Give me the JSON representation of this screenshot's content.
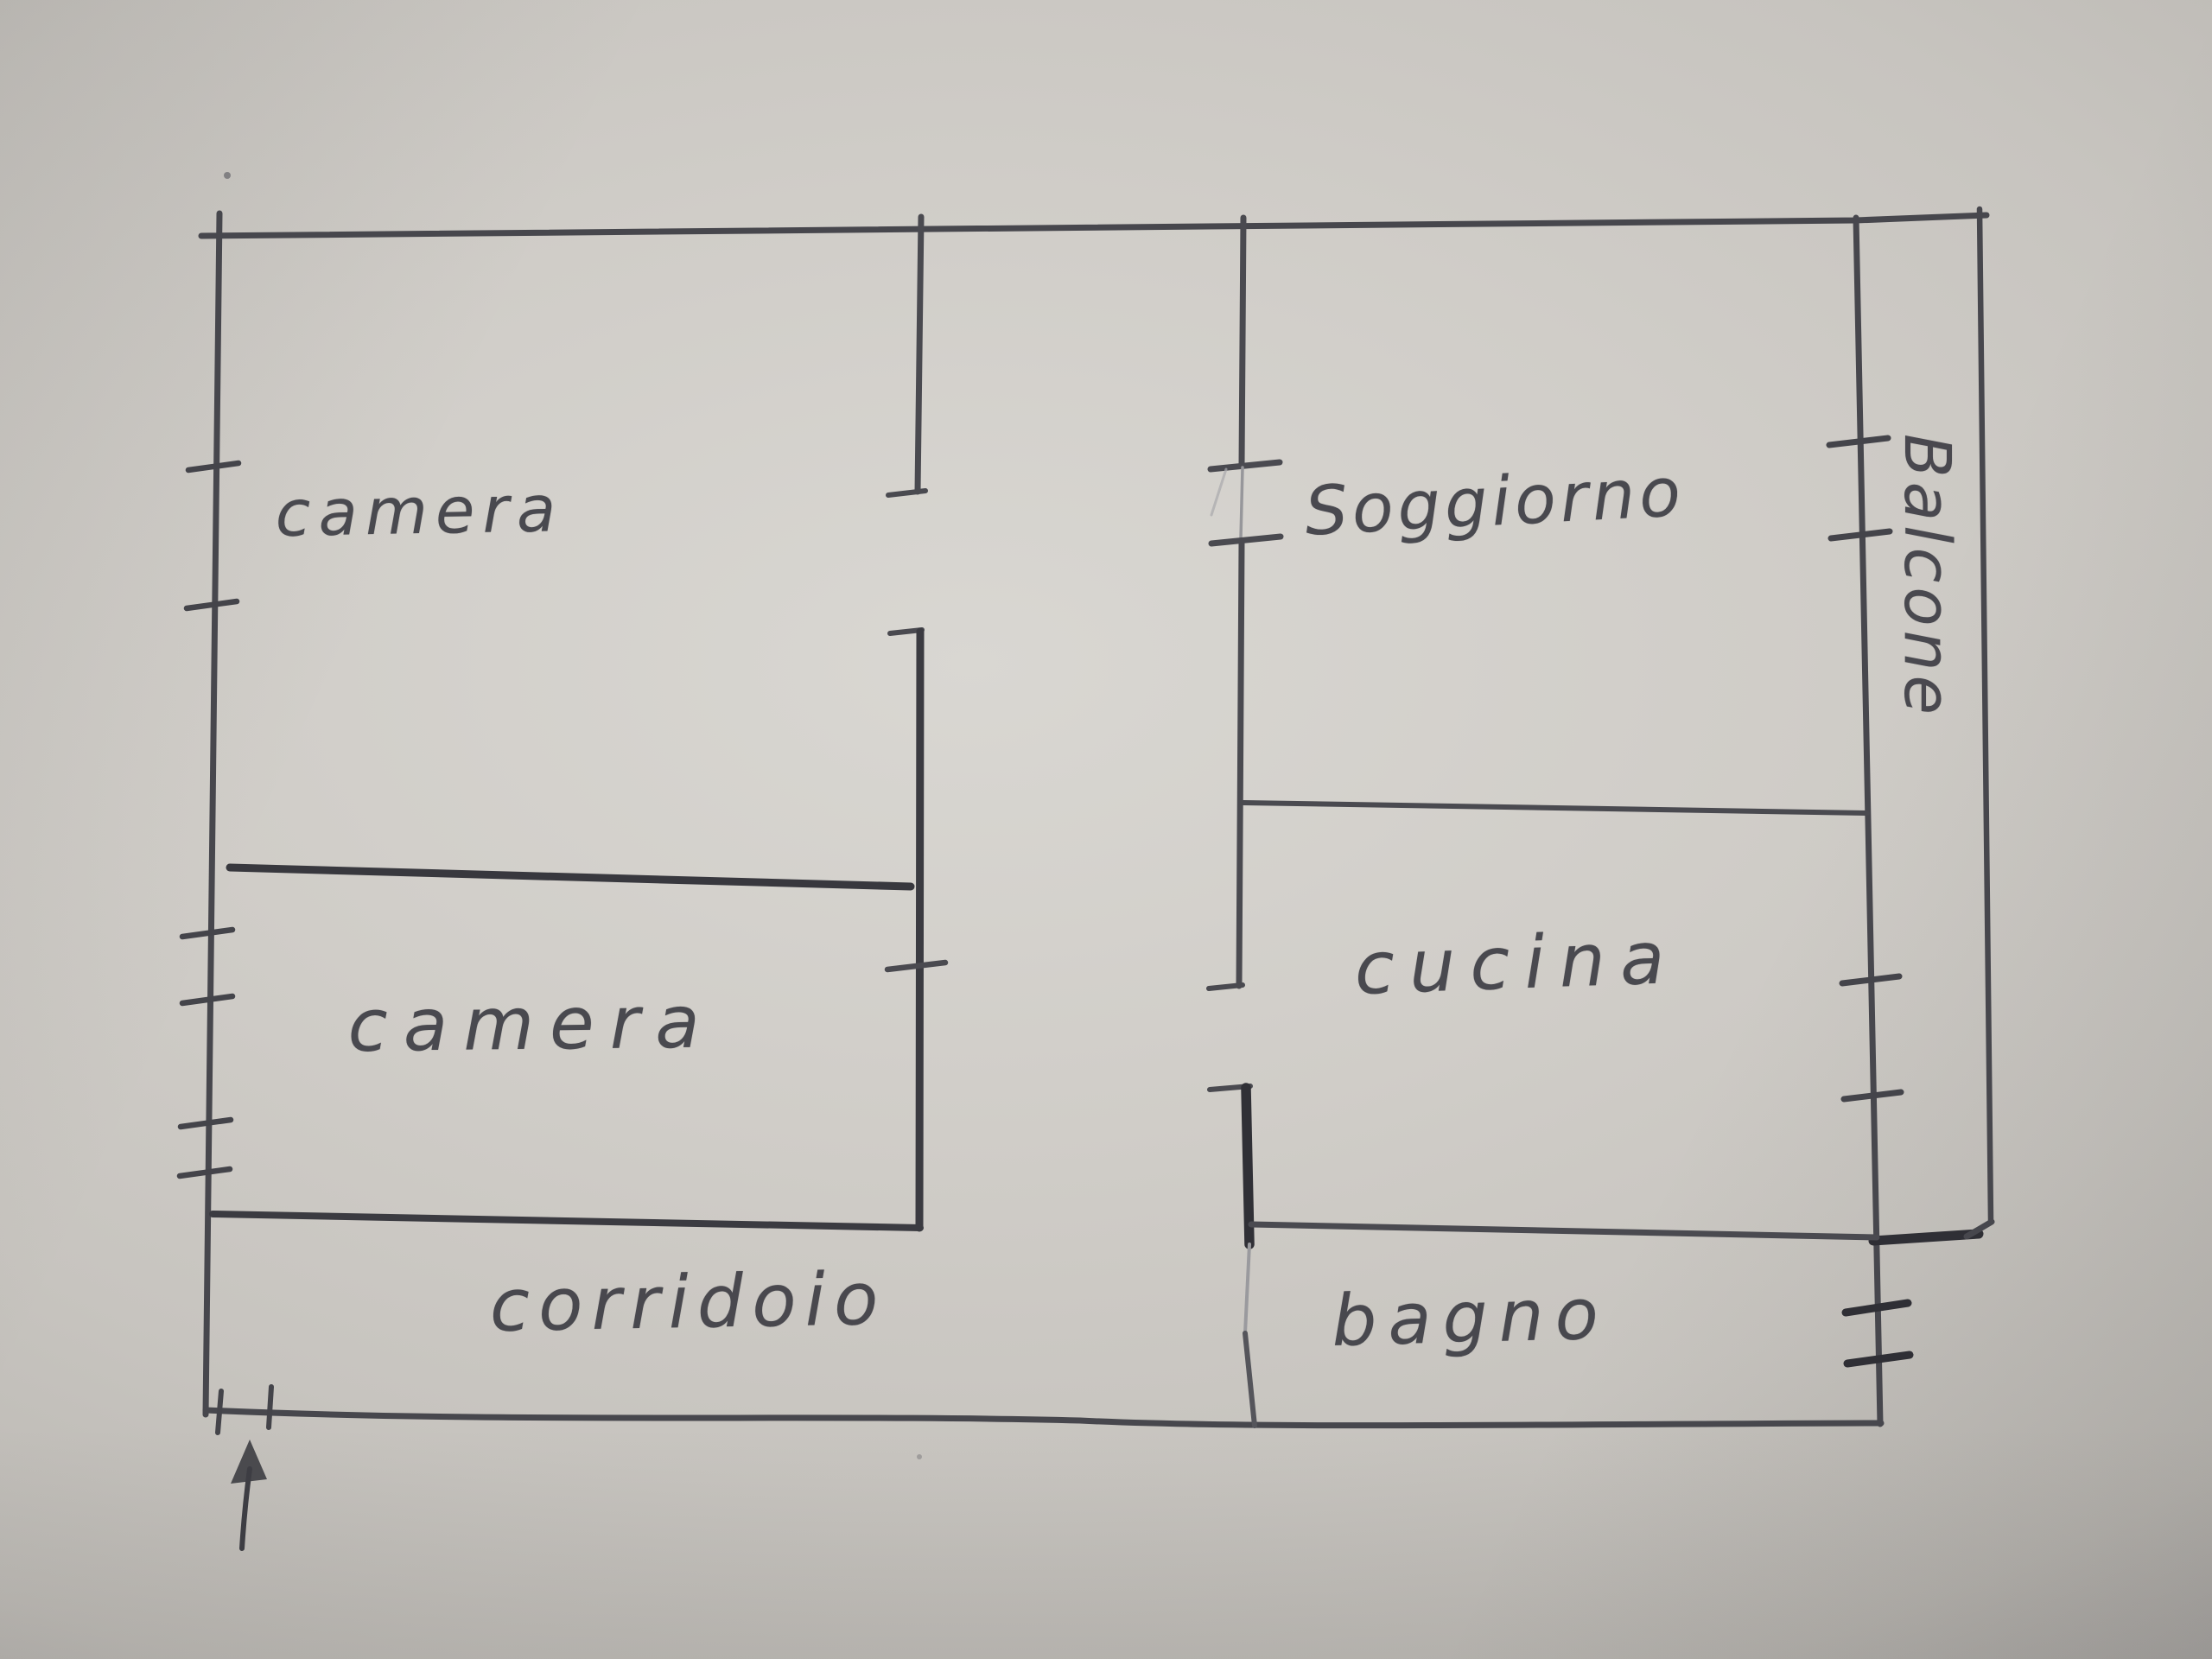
{
  "palette": {
    "paper": "#d0cdc8",
    "pencil": "#4a4a50",
    "pencil_dark": "#303036",
    "pencil_faint": "#97979b"
  },
  "floor_plan": {
    "kind": "hand-drawn apartment floor plan",
    "rooms": [
      {
        "id": "camera-1",
        "label": "camera"
      },
      {
        "id": "camera-2",
        "label": "camera"
      },
      {
        "id": "soggiorno",
        "label": "Soggiorno"
      },
      {
        "id": "cucina",
        "label": "cucina"
      },
      {
        "id": "bagno",
        "label": "bagno"
      },
      {
        "id": "corridoio",
        "label": "corridoio"
      },
      {
        "id": "balcone",
        "label": "Balcone"
      }
    ]
  }
}
